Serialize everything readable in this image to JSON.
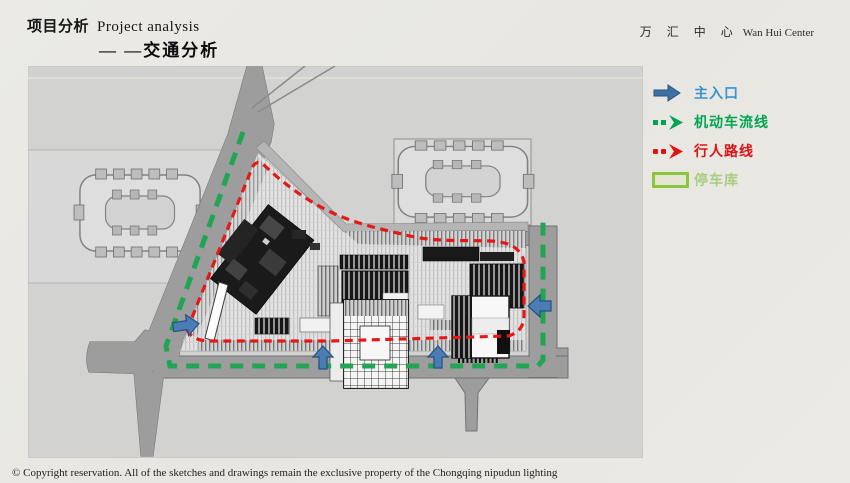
{
  "header": {
    "title_zh": "项目分析",
    "title_en": "Project analysis",
    "subtitle": "— —交通分析"
  },
  "logo": {
    "zh": "万 汇 中 心",
    "en": "Wan Hui Center"
  },
  "legend": {
    "items": [
      {
        "label": "主入口",
        "icon": "solid-arrow-right",
        "color": "#3a93cd"
      },
      {
        "label": "机动车流线",
        "icon": "green-dashed-arrow",
        "color": "#00a452"
      },
      {
        "label": "行人路线",
        "icon": "red-dashed-arrow",
        "color": "#e01212"
      },
      {
        "label": "停车库",
        "icon": "parking-swatch",
        "color": "#a9cd7e"
      }
    ]
  },
  "plan": {
    "type": "site-plan traffic analysis drawing",
    "routes": {
      "vehicle_route_color": "#22a455",
      "pedestrian_route_color": "#e51818",
      "entrance_arrow_color": "#4b7cb4"
    },
    "surfaces": {
      "plan_background": "#d2d2d1",
      "road_color": "#9d9d9d",
      "building_dark": "#1a1a1a",
      "parking_fill": "#e2e6d3",
      "parking_border": "#8cc63f"
    }
  },
  "footer": {
    "copyright": "© Copyright reservation. All of the sketches and drawings remain the exclusive property of the Chongqing nipudun lighting"
  }
}
